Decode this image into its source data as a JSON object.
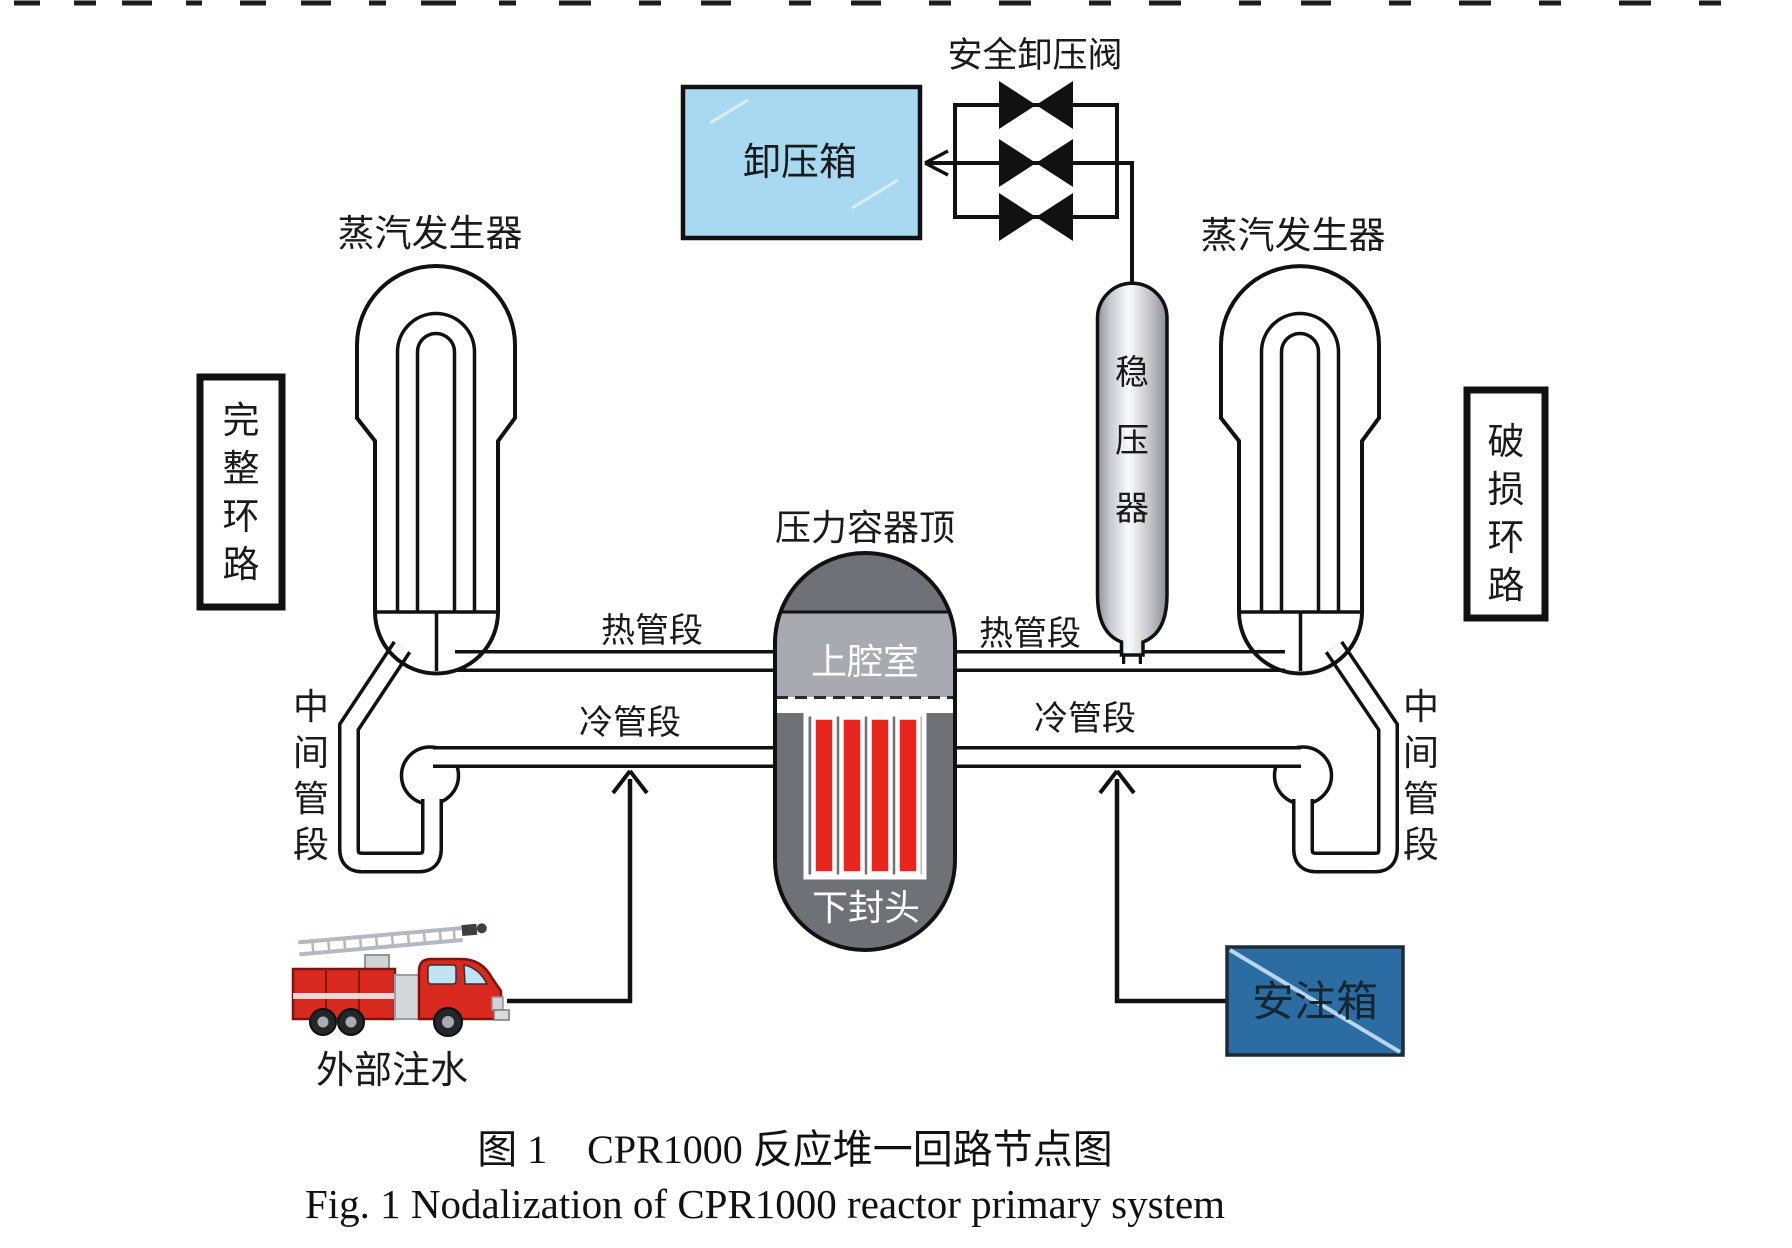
{
  "diagram": {
    "labels": {
      "safety_relief_valve": "安全卸压阀",
      "relief_tank": "卸压箱",
      "sg_left": "蒸汽发生器",
      "sg_right": "蒸汽发生器",
      "pressurizer": [
        "稳",
        "压",
        "器"
      ],
      "intact_loop": [
        "完",
        "整",
        "环",
        "路"
      ],
      "broken_loop": [
        "破",
        "损",
        "环",
        "路"
      ],
      "vessel_top_label": "压力容器顶",
      "upper_plenum": "上腔室",
      "lower_head": "下封头",
      "hot_leg_left": "热管段",
      "hot_leg_right": "热管段",
      "cold_leg_left": "冷管段",
      "cold_leg_right": "冷管段",
      "intermediate_leg_left": [
        "中",
        "间",
        "管",
        "段"
      ],
      "intermediate_leg_right": [
        "中",
        "间",
        "管",
        "段"
      ],
      "external_injection": "外部注水",
      "injection_tank": "安注箱"
    },
    "caption_zh": "图 1　CPR1000 反应堆一回路节点图",
    "caption_en": "Fig. 1  Nodalization of CPR1000 reactor primary system",
    "colors": {
      "relief_tank_fill": "#a9d9f1",
      "injection_tank_fill": "#2b6ca3",
      "injection_tank_stripe": "#b9d6ec",
      "vessel_dark": "#6e7277",
      "vessel_light": "#a7abb1",
      "core_red": "#e8251f",
      "truck_red": "#d8291f",
      "line": "#111111"
    }
  }
}
